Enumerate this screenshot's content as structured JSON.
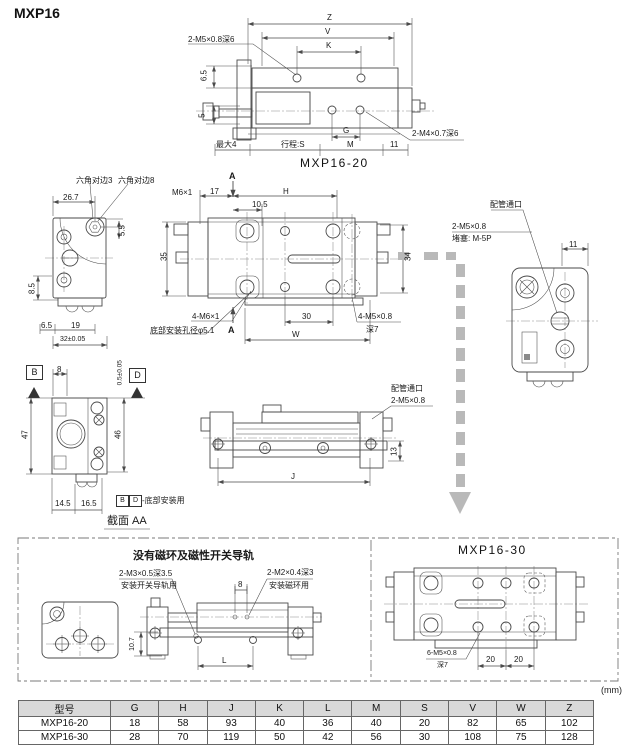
{
  "page": {
    "title": "MXP16",
    "units_note": "(mm)"
  },
  "side_view": {
    "caption": "MXP16-20",
    "note_thread_top": "2-M5×0.8深6",
    "note_thread_bottom": "2-M4×0.7深6",
    "dim_z": "Z",
    "dim_v": "V",
    "dim_k": "K",
    "dim_65": "6.5",
    "dim_5": "5",
    "dim_max4": "最大4",
    "dim_stroke": "行程:S",
    "dim_m": "M",
    "dim_11": "11",
    "dim_g": "G"
  },
  "left_end_view": {
    "note_hex3": "六角对边3",
    "note_hex8": "六角对边8",
    "dim_267": "26.7",
    "dim_55": "5.5",
    "dim_85": "8.5",
    "dim_65": "6.5",
    "dim_19": "19",
    "dim_32": "32±0.05"
  },
  "plan_view": {
    "section_mark": "A",
    "note_m6": "M6×1",
    "dim_17": "17",
    "dim_h": "H",
    "dim_105": "10.5",
    "dim_35": "35",
    "dim_34": "34",
    "note_bolt": "4-M6×1",
    "note_hole": "底部安装孔径φ5.1",
    "dim_30": "30",
    "dim_w": "W",
    "note_thread": "4-M5×0.8",
    "note_depth": "深7"
  },
  "right_end_view": {
    "note_port": "配管通口",
    "note_thread": "2-M5×0.8",
    "note_plug": "堵塞: M-5P",
    "dim_11": "11"
  },
  "section_bd": {
    "mark_b": "B",
    "mark_d": "D",
    "dim_8": "8",
    "dim_tol": "0.5±0.05",
    "dim_47": "47",
    "dim_46": "46",
    "dim_145": "14.5",
    "dim_165": "16.5",
    "note_suffix": "-底部安装用",
    "caption": "截面 AA"
  },
  "lower_side_view": {
    "note_port": "配管通口",
    "note_thread": "2-M5×0.8",
    "dim_j": "J",
    "dim_13": "13"
  },
  "no_magnet_section": {
    "title": "没有磁环及磁性开关导轨",
    "note_rail_thread": "2-M3×0.5深3.5",
    "note_rail_use": "安装开关导轨用",
    "note_ring_thread": "2-M2×0.4深3",
    "note_ring_use": "安装磁环用",
    "dim_8": "8",
    "dim_l": "L",
    "dim_107": "10.7"
  },
  "mxp16_30_view": {
    "caption": "MXP16-30",
    "note_thread": "6-M5×0.8",
    "note_depth": "深7",
    "dim_20a": "20",
    "dim_20b": "20"
  },
  "table": {
    "headers": [
      "型号",
      "G",
      "H",
      "J",
      "K",
      "L",
      "M",
      "S",
      "V",
      "W",
      "Z"
    ],
    "rows": [
      {
        "model": "MXP16-20",
        "values": [
          "18",
          "58",
          "93",
          "40",
          "36",
          "40",
          "20",
          "82",
          "65",
          "102"
        ]
      },
      {
        "model": "MXP16-30",
        "values": [
          "28",
          "70",
          "119",
          "50",
          "42",
          "56",
          "30",
          "108",
          "75",
          "128"
        ]
      }
    ]
  }
}
